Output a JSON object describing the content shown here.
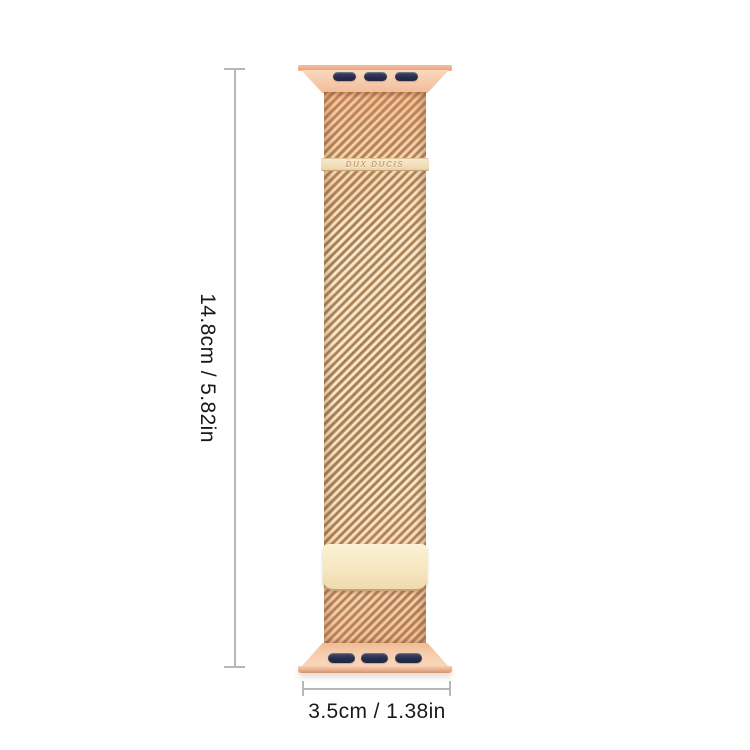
{
  "product": {
    "brand_label": "DUX DUCIS",
    "description": "rose gold milanese loop watch band"
  },
  "dimensions": {
    "height_label": "14.8cm / 5.82in",
    "width_label": "3.5cm / 1.38in"
  },
  "colors": {
    "background": "#ffffff",
    "band_mesh_light": "#f6ecd6",
    "band_mesh_stripe": "#a87c52",
    "adapter_salmon": "#f6cdad",
    "clasp_plate": "#f7e7c2",
    "slot_navy": "#272e4c",
    "dimension_line": "#b7b7b7",
    "label_text": "#191919"
  }
}
